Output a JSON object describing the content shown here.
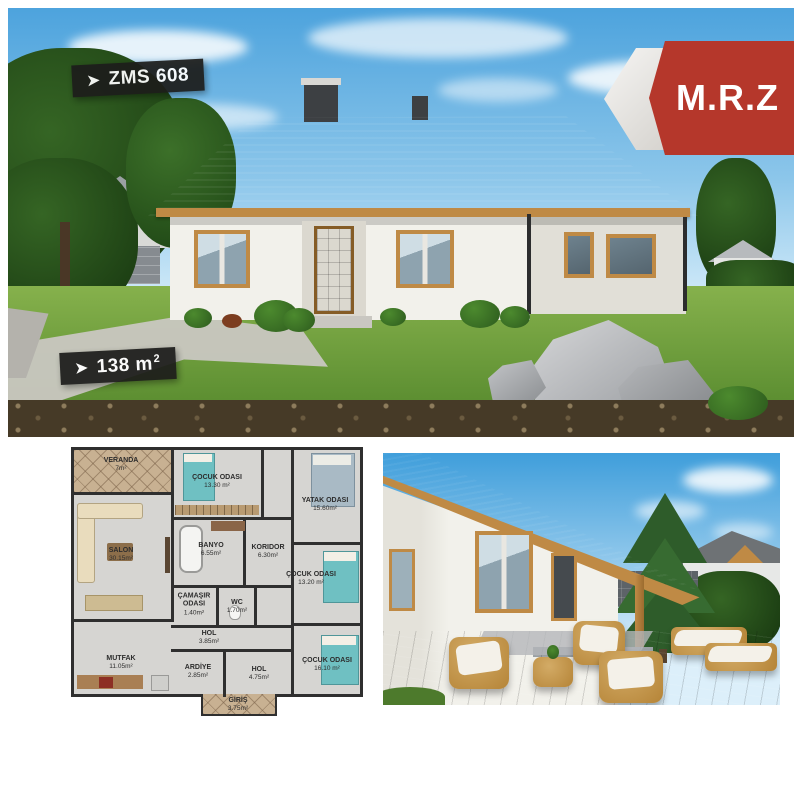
{
  "palette": {
    "accent_red": "#b5372b",
    "banner_bg": "#1d1d1b",
    "roof_gray": "#46494c",
    "wall_white": "#f2f1eb",
    "wood": "#bf8a45",
    "grass_green": "#6fa03c",
    "sky_blue": "#4da3dd",
    "plan_floor": "#d6d5d2",
    "plan_tile": "#c8b192",
    "plan_wall": "#2f2f2f",
    "teal_bed": "#6fc0c2"
  },
  "top_photo": {
    "model_badge": {
      "arrow": "➤",
      "label": "ZMS 608"
    },
    "area_badge": {
      "arrow": "➤",
      "value": "138 m",
      "sup": "2"
    },
    "brand_badge": {
      "label": "M.R.Z"
    }
  },
  "floor_plan": {
    "rooms": [
      {
        "name": "VERANDA",
        "area": "7m²"
      },
      {
        "name": "ÇOCUK ODASI",
        "area": "13.30 m²"
      },
      {
        "name": "YATAK ODASI",
        "area": "15.60m²"
      },
      {
        "name": "SALON",
        "area": "30.15m²"
      },
      {
        "name": "BANYO",
        "area": "6.55m²"
      },
      {
        "name": "KORIDOR",
        "area": "6.30m²"
      },
      {
        "name": "ÇOCUK ODASI",
        "area": "13.20 m²"
      },
      {
        "name": "ÇAMAŞIR ODASI",
        "area": "1.40m²"
      },
      {
        "name": "WC",
        "area": "1.70m²"
      },
      {
        "name": "HOL",
        "area": "3.85m²"
      },
      {
        "name": "ARDİYE",
        "area": "2.85m²"
      },
      {
        "name": "HOL",
        "area": "4.75m²"
      },
      {
        "name": "ÇOCUK ODASI",
        "area": "16.10 m²"
      },
      {
        "name": "MUTFAK",
        "area": "11.05m²"
      },
      {
        "name": "GİRİŞ",
        "area": "3.75m²"
      }
    ]
  }
}
